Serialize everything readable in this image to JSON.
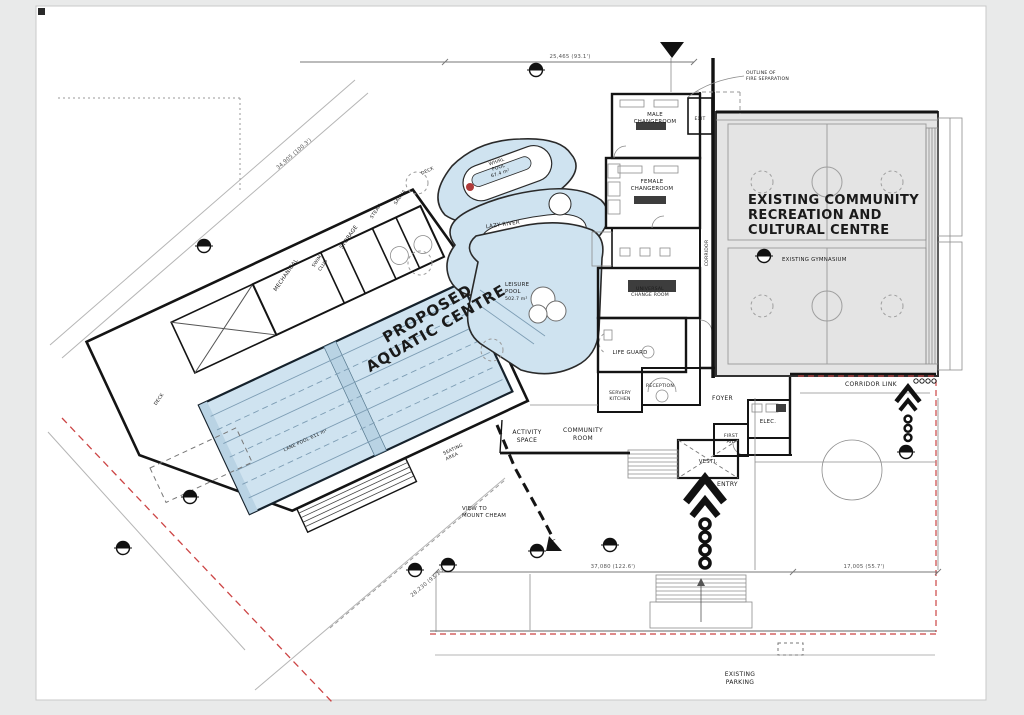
{
  "title": {
    "proposed_line1": "PROPOSED",
    "proposed_line2": "AQUATIC CENTRE",
    "existing_line1": "EXISTING COMMUNITY",
    "existing_line2": "RECREATION AND",
    "existing_line3": "CULTURAL CENTRE"
  },
  "rooms": {
    "mechanical": "MECHANICAL",
    "swim_club_1": "SWIM",
    "swim_club_2": "CLUB",
    "storage": "STORAGE",
    "steam": "STEAM",
    "sauna": "SAUNA",
    "deck_west": "DECK",
    "deck_north": "DECK",
    "male_1": "MALE",
    "male_2": "CHANGEROOM",
    "exit": "EXIT",
    "female_1": "FEMALE",
    "female_2": "CHANGEROOM",
    "universal_1": "UNIVERSAL",
    "universal_2": "CHANGE ROOM",
    "life_guard": "LIFE GUARD",
    "reception": "RECEPTION",
    "servery_1": "SERVERY",
    "servery_2": "KITCHEN",
    "foyer": "FOYER",
    "elec": "ELEC.",
    "first_aid_1": "FIRST",
    "first_aid_2": "AID",
    "vesti": "VESTI.",
    "corridor": "CORRIDOR",
    "corridor_link": "CORRIDOR LINK",
    "community_1": "COMMUNITY",
    "community_2": "ROOM",
    "activity_1": "ACTIVITY",
    "activity_2": "SPACE",
    "gymnasium": "EXISTING GYMNASIUM",
    "seating_1": "SEATING",
    "seating_2": "AREA"
  },
  "pools": {
    "lane": "LANE POOL  611 m²",
    "leisure_1": "LEISURE",
    "leisure_2": "POOL",
    "leisure_area": "502.7 m²",
    "lazy": "LAZY RIVER",
    "whirl_1": "WHIRL",
    "whirl_2": "POOL",
    "whirl_area": "67.4 m²"
  },
  "site": {
    "entry": "ENTRY",
    "parking_1": "EXISTING",
    "parking_2": "PARKING",
    "view_1": "VIEW TO",
    "view_2": "MOUNT CHEAM",
    "fire_1": "OUTLINE OF",
    "fire_2": "FIRE SEPARATION"
  },
  "dimensions": {
    "top": "25,465 (93.1')",
    "west": "34,905 (100.3')",
    "southwest": "28,230 (93.1')",
    "plaza": "37,080 (122.6')",
    "plaza_east": "17,005 (55.7')"
  },
  "colors": {
    "pool": "#cfe3f0",
    "pool_deep": "#b9d3e4",
    "gym": "#e4e4e4",
    "red_line": "#cc4444",
    "marker_red": "#b03a3a"
  }
}
